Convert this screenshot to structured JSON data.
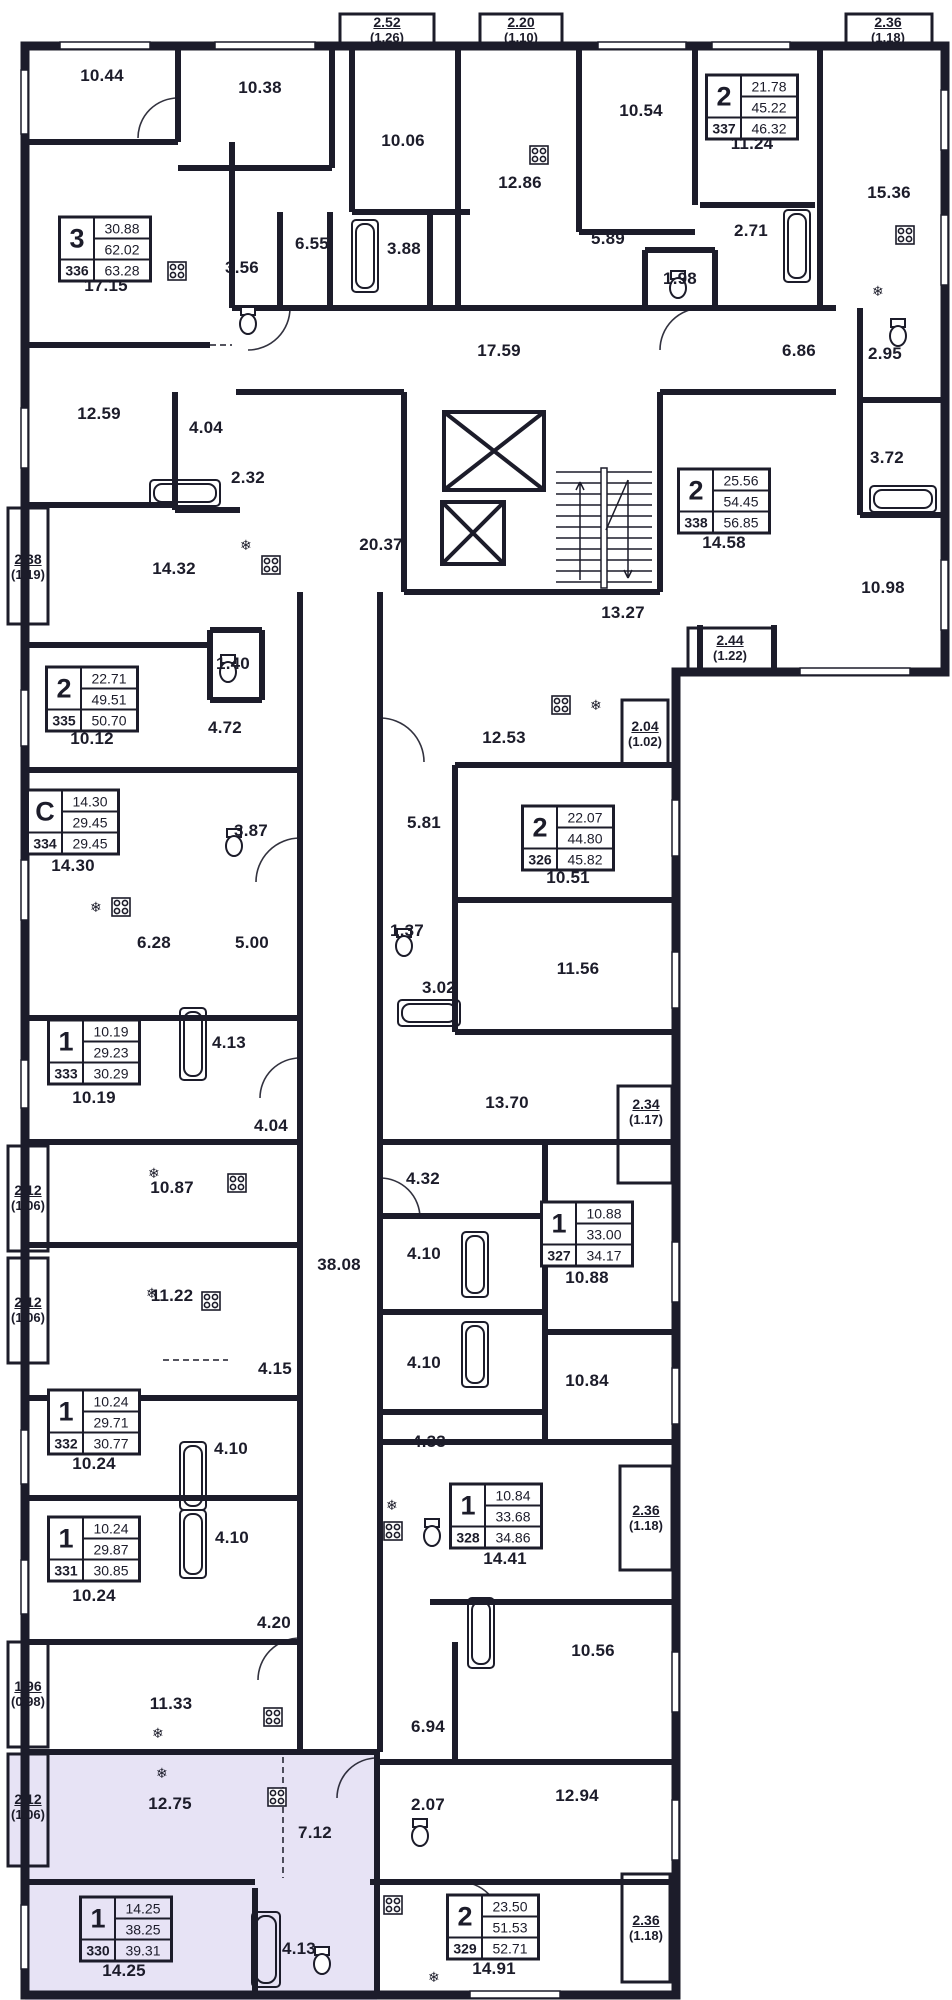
{
  "plan_title": "Floor plan",
  "highlighted_apartment_number": "330",
  "colors": {
    "wall": "#1c1c2a",
    "highlight": "#e7e3f5",
    "background": "#ffffff"
  },
  "icons": {
    "fridge": "❄"
  },
  "apartments": [
    {
      "type": "3",
      "v1": "30.88",
      "v2": "62.02",
      "num": "336",
      "v3": "63.28",
      "x": 105,
      "y": 249
    },
    {
      "type": "2",
      "v1": "21.78",
      "v2": "45.22",
      "num": "337",
      "v3": "46.32",
      "x": 752,
      "y": 107
    },
    {
      "type": "2",
      "v1": "25.56",
      "v2": "54.45",
      "num": "338",
      "v3": "56.85",
      "x": 724,
      "y": 501
    },
    {
      "type": "2",
      "v1": "22.71",
      "v2": "49.51",
      "num": "335",
      "v3": "50.70",
      "x": 92,
      "y": 699
    },
    {
      "type": "С",
      "v1": "14.30",
      "v2": "29.45",
      "num": "334",
      "v3": "29.45",
      "x": 73,
      "y": 822
    },
    {
      "type": "2",
      "v1": "22.07",
      "v2": "44.80",
      "num": "326",
      "v3": "45.82",
      "x": 568,
      "y": 838
    },
    {
      "type": "1",
      "v1": "10.19",
      "v2": "29.23",
      "num": "333",
      "v3": "30.29",
      "x": 94,
      "y": 1052
    },
    {
      "type": "1",
      "v1": "10.88",
      "v2": "33.00",
      "num": "327",
      "v3": "34.17",
      "x": 587,
      "y": 1234
    },
    {
      "type": "1",
      "v1": "10.24",
      "v2": "29.71",
      "num": "332",
      "v3": "30.77",
      "x": 94,
      "y": 1422
    },
    {
      "type": "1",
      "v1": "10.84",
      "v2": "33.68",
      "num": "328",
      "v3": "34.86",
      "x": 496,
      "y": 1516
    },
    {
      "type": "1",
      "v1": "10.24",
      "v2": "29.87",
      "num": "331",
      "v3": "30.85",
      "x": 94,
      "y": 1549
    },
    {
      "type": "1",
      "v1": "14.25",
      "v2": "38.25",
      "num": "330",
      "v3": "39.31",
      "x": 126,
      "y": 1929,
      "highlighted": true
    },
    {
      "type": "2",
      "v1": "23.50",
      "v2": "51.53",
      "num": "329",
      "v3": "52.71",
      "x": 493,
      "y": 1927
    }
  ],
  "room_labels": [
    {
      "t": "10.44",
      "x": 102,
      "y": 76
    },
    {
      "t": "10.38",
      "x": 260,
      "y": 88
    },
    {
      "t": "10.06",
      "x": 403,
      "y": 141
    },
    {
      "t": "10.54",
      "x": 641,
      "y": 111
    },
    {
      "t": "12.86",
      "x": 520,
      "y": 183
    },
    {
      "t": "11.24",
      "x": 752,
      "y": 144
    },
    {
      "t": "15.36",
      "x": 889,
      "y": 193
    },
    {
      "t": "17.15",
      "x": 106,
      "y": 286
    },
    {
      "t": "3.56",
      "x": 242,
      "y": 268
    },
    {
      "t": "6.55",
      "x": 312,
      "y": 244
    },
    {
      "t": "3.88",
      "x": 404,
      "y": 249
    },
    {
      "t": "5.89",
      "x": 608,
      "y": 239
    },
    {
      "t": "2.71",
      "x": 751,
      "y": 231
    },
    {
      "t": "1.98",
      "x": 680,
      "y": 279
    },
    {
      "t": "17.59",
      "x": 499,
      "y": 351
    },
    {
      "t": "6.86",
      "x": 799,
      "y": 351
    },
    {
      "t": "2.95",
      "x": 885,
      "y": 354
    },
    {
      "t": "12.59",
      "x": 99,
      "y": 414
    },
    {
      "t": "4.04",
      "x": 206,
      "y": 428
    },
    {
      "t": "2.32",
      "x": 248,
      "y": 478
    },
    {
      "t": "3.72",
      "x": 887,
      "y": 458
    },
    {
      "t": "14.32",
      "x": 174,
      "y": 569
    },
    {
      "t": "20.37",
      "x": 381,
      "y": 545
    },
    {
      "t": "14.58",
      "x": 724,
      "y": 543
    },
    {
      "t": "10.98",
      "x": 883,
      "y": 588
    },
    {
      "t": "13.27",
      "x": 623,
      "y": 613
    },
    {
      "t": "1.40",
      "x": 233,
      "y": 664
    },
    {
      "t": "4.72",
      "x": 225,
      "y": 728
    },
    {
      "t": "10.12",
      "x": 92,
      "y": 739
    },
    {
      "t": "12.53",
      "x": 504,
      "y": 738
    },
    {
      "t": "14.30",
      "x": 73,
      "y": 866
    },
    {
      "t": "3.87",
      "x": 251,
      "y": 831
    },
    {
      "t": "5.81",
      "x": 424,
      "y": 823
    },
    {
      "t": "10.51",
      "x": 568,
      "y": 878
    },
    {
      "t": "6.28",
      "x": 154,
      "y": 943
    },
    {
      "t": "5.00",
      "x": 252,
      "y": 943
    },
    {
      "t": "1.37",
      "x": 407,
      "y": 931
    },
    {
      "t": "11.56",
      "x": 578,
      "y": 969
    },
    {
      "t": "3.02",
      "x": 439,
      "y": 988
    },
    {
      "t": "10.19",
      "x": 94,
      "y": 1098
    },
    {
      "t": "4.13",
      "x": 229,
      "y": 1043
    },
    {
      "t": "13.70",
      "x": 507,
      "y": 1103
    },
    {
      "t": "4.04",
      "x": 271,
      "y": 1126
    },
    {
      "t": "10.87",
      "x": 172,
      "y": 1188
    },
    {
      "t": "4.32",
      "x": 423,
      "y": 1179
    },
    {
      "t": "38.08",
      "x": 339,
      "y": 1265
    },
    {
      "t": "4.10",
      "x": 424,
      "y": 1254
    },
    {
      "t": "10.88",
      "x": 587,
      "y": 1278
    },
    {
      "t": "11.22",
      "x": 172,
      "y": 1296
    },
    {
      "t": "4.10",
      "x": 424,
      "y": 1363
    },
    {
      "t": "10.84",
      "x": 587,
      "y": 1381
    },
    {
      "t": "4.15",
      "x": 275,
      "y": 1369
    },
    {
      "t": "4.33",
      "x": 429,
      "y": 1442
    },
    {
      "t": "4.10",
      "x": 231,
      "y": 1449
    },
    {
      "t": "10.24",
      "x": 94,
      "y": 1464
    },
    {
      "t": "4.10",
      "x": 232,
      "y": 1538
    },
    {
      "t": "14.41",
      "x": 505,
      "y": 1559
    },
    {
      "t": "10.24",
      "x": 94,
      "y": 1596
    },
    {
      "t": "4.20",
      "x": 274,
      "y": 1623
    },
    {
      "t": "10.56",
      "x": 593,
      "y": 1651
    },
    {
      "t": "11.33",
      "x": 171,
      "y": 1704
    },
    {
      "t": "6.94",
      "x": 428,
      "y": 1727
    },
    {
      "t": "12.75",
      "x": 170,
      "y": 1804
    },
    {
      "t": "2.07",
      "x": 428,
      "y": 1805
    },
    {
      "t": "7.12",
      "x": 315,
      "y": 1833
    },
    {
      "t": "12.94",
      "x": 577,
      "y": 1796
    },
    {
      "t": "4.13",
      "x": 299,
      "y": 1949
    },
    {
      "t": "14.25",
      "x": 124,
      "y": 1971
    },
    {
      "t": "14.91",
      "x": 494,
      "y": 1969
    }
  ],
  "balcony_labels": [
    {
      "t": "2.52",
      "s": "(1.26)",
      "x": 387,
      "y": 30
    },
    {
      "t": "2.20",
      "s": "(1.10)",
      "x": 521,
      "y": 30
    },
    {
      "t": "2.36",
      "s": "(1.18)",
      "x": 888,
      "y": 30
    },
    {
      "t": "2.38",
      "s": "(1.19)",
      "x": 28,
      "y": 567
    },
    {
      "t": "2.44",
      "s": "(1.22)",
      "x": 730,
      "y": 648
    },
    {
      "t": "2.04",
      "s": "(1.02)",
      "x": 645,
      "y": 734
    },
    {
      "t": "2.34",
      "s": "(1.17)",
      "x": 646,
      "y": 1112
    },
    {
      "t": "2.12",
      "s": "(1.06)",
      "x": 28,
      "y": 1198
    },
    {
      "t": "2.12",
      "s": "(1.06)",
      "x": 28,
      "y": 1310
    },
    {
      "t": "2.36",
      "s": "(1.18)",
      "x": 646,
      "y": 1518
    },
    {
      "t": "1.96",
      "s": "(0.98)",
      "x": 28,
      "y": 1694
    },
    {
      "t": "2.12",
      "s": "(1.06)",
      "x": 28,
      "y": 1807
    },
    {
      "t": "2.36",
      "s": "(1.18)",
      "x": 646,
      "y": 1928
    }
  ]
}
